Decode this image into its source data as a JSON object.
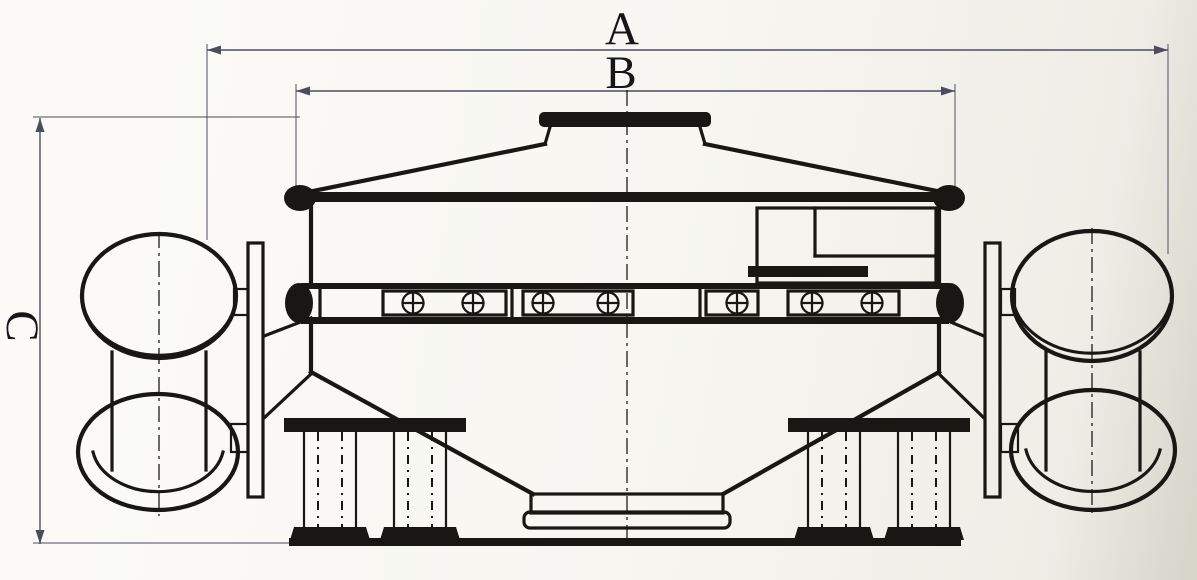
{
  "page": {
    "colors": {
      "paper": "#f7f6f1",
      "paper-edge": "#d8d5cb",
      "ink": "#181713",
      "dim": "#4a4e5c"
    }
  },
  "dimensions": {
    "overall_length": {
      "label": "A"
    },
    "body_width": {
      "label": "B"
    },
    "overall_height": {
      "label": "C"
    }
  }
}
